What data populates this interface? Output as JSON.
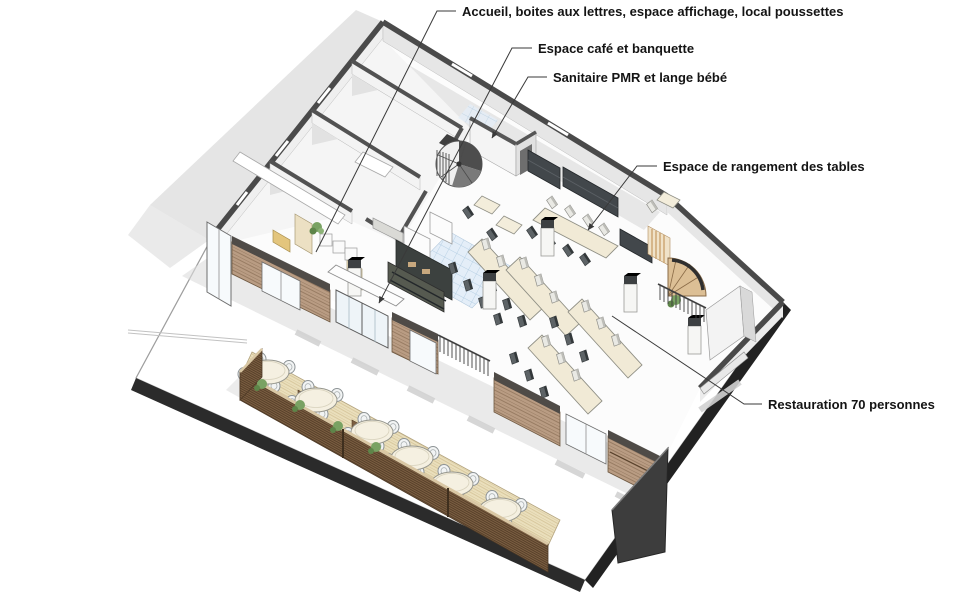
{
  "page": {
    "type": "axonometric-floor-plan-diagram",
    "background": "#ffffff"
  },
  "labels": {
    "accueil": {
      "text": "Accueil, boites aux lettres, espace affichage, local poussettes"
    },
    "espace_cafe": {
      "text": "Espace café et banquette"
    },
    "sanitaire": {
      "text": "Sanitaire PMR et lange bébé"
    },
    "rangement": {
      "text": "Espace de rangement des tables"
    },
    "restauration": {
      "text": "Restauration 70 personnes"
    }
  },
  "colors": {
    "cut_wall": "#4a4a4a",
    "wall_face": "#eeeeee",
    "slab_edge": "#2b2b2b",
    "wood_facade": "#b99c83",
    "terrace_fence": "#7a5d40",
    "terrace_deck": "#e9dcb8",
    "table_top": "#f1ead6",
    "dark_cabinet": "#42474b",
    "tile_floor": "#dce9f5",
    "plant_green": "#79a263",
    "shadow": "#dcdcdc",
    "leader_line": "#3a3a3a"
  }
}
